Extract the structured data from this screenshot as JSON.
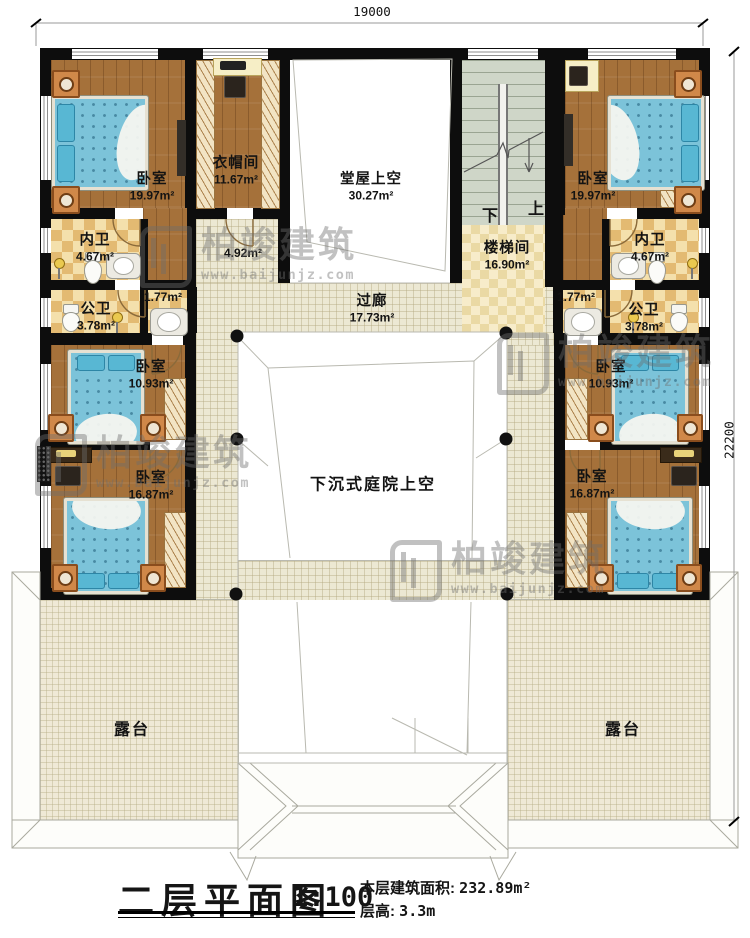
{
  "meta": {
    "title": "二层平面图",
    "scale": "1:100",
    "area_label": "本层建筑面积: ",
    "area_value": "232.89m²",
    "height_label": "层高: ",
    "height_value": "3.3m"
  },
  "dimensions": {
    "top": "19000",
    "right": "22200"
  },
  "watermark": {
    "brand": "柏竣建筑",
    "url": "www.baijunjz.com"
  },
  "stair": {
    "down": "下",
    "up": "上"
  },
  "rooms": {
    "bedroom_tl": {
      "name": "卧室",
      "area": "19.97m²"
    },
    "closet": {
      "name": "衣帽间",
      "area": "11.67m²"
    },
    "hall_void": {
      "name": "堂屋上空",
      "area": "30.27m²"
    },
    "bedroom_tr": {
      "name": "卧室",
      "area": "19.97m²"
    },
    "bath_inner_l": {
      "name": "内卫",
      "area": "4.67m²"
    },
    "bath_inner_r": {
      "name": "内卫",
      "area": "4.67m²"
    },
    "hall_small": {
      "area": "4.92m²"
    },
    "stairwell": {
      "name": "楼梯间",
      "area": "16.90m²"
    },
    "bath_public_l": {
      "name": "公卫",
      "area": "3.78m²"
    },
    "bath_public_r": {
      "name": "公卫",
      "area": "3.78m²"
    },
    "wash_l": {
      "area": "1.77m²"
    },
    "wash_r": {
      "area": "1.77m²"
    },
    "corridor": {
      "name": "过廊",
      "area": "17.73m²"
    },
    "bedroom_ml": {
      "name": "卧室",
      "area": "10.93m²"
    },
    "bedroom_mr": {
      "name": "卧室",
      "area": "10.93m²"
    },
    "bedroom_bl": {
      "name": "卧室",
      "area": "16.87m²"
    },
    "bedroom_br": {
      "name": "卧室",
      "area": "16.87m²"
    },
    "courtyard": {
      "name": "下沉式庭院上空"
    },
    "terrace_l": {
      "name": "露台"
    },
    "terrace_r": {
      "name": "露台"
    }
  },
  "colors": {
    "wall": "#0d0d0d",
    "wood_floor": "#a5713a",
    "bath_tile": "#e3ba72",
    "corridor_floor": "#ece8d3",
    "stair_floor": "#cfd6c8",
    "bed": "#7cc3d9",
    "nightstand": "#d08849",
    "courtyard": "#ffffff"
  }
}
